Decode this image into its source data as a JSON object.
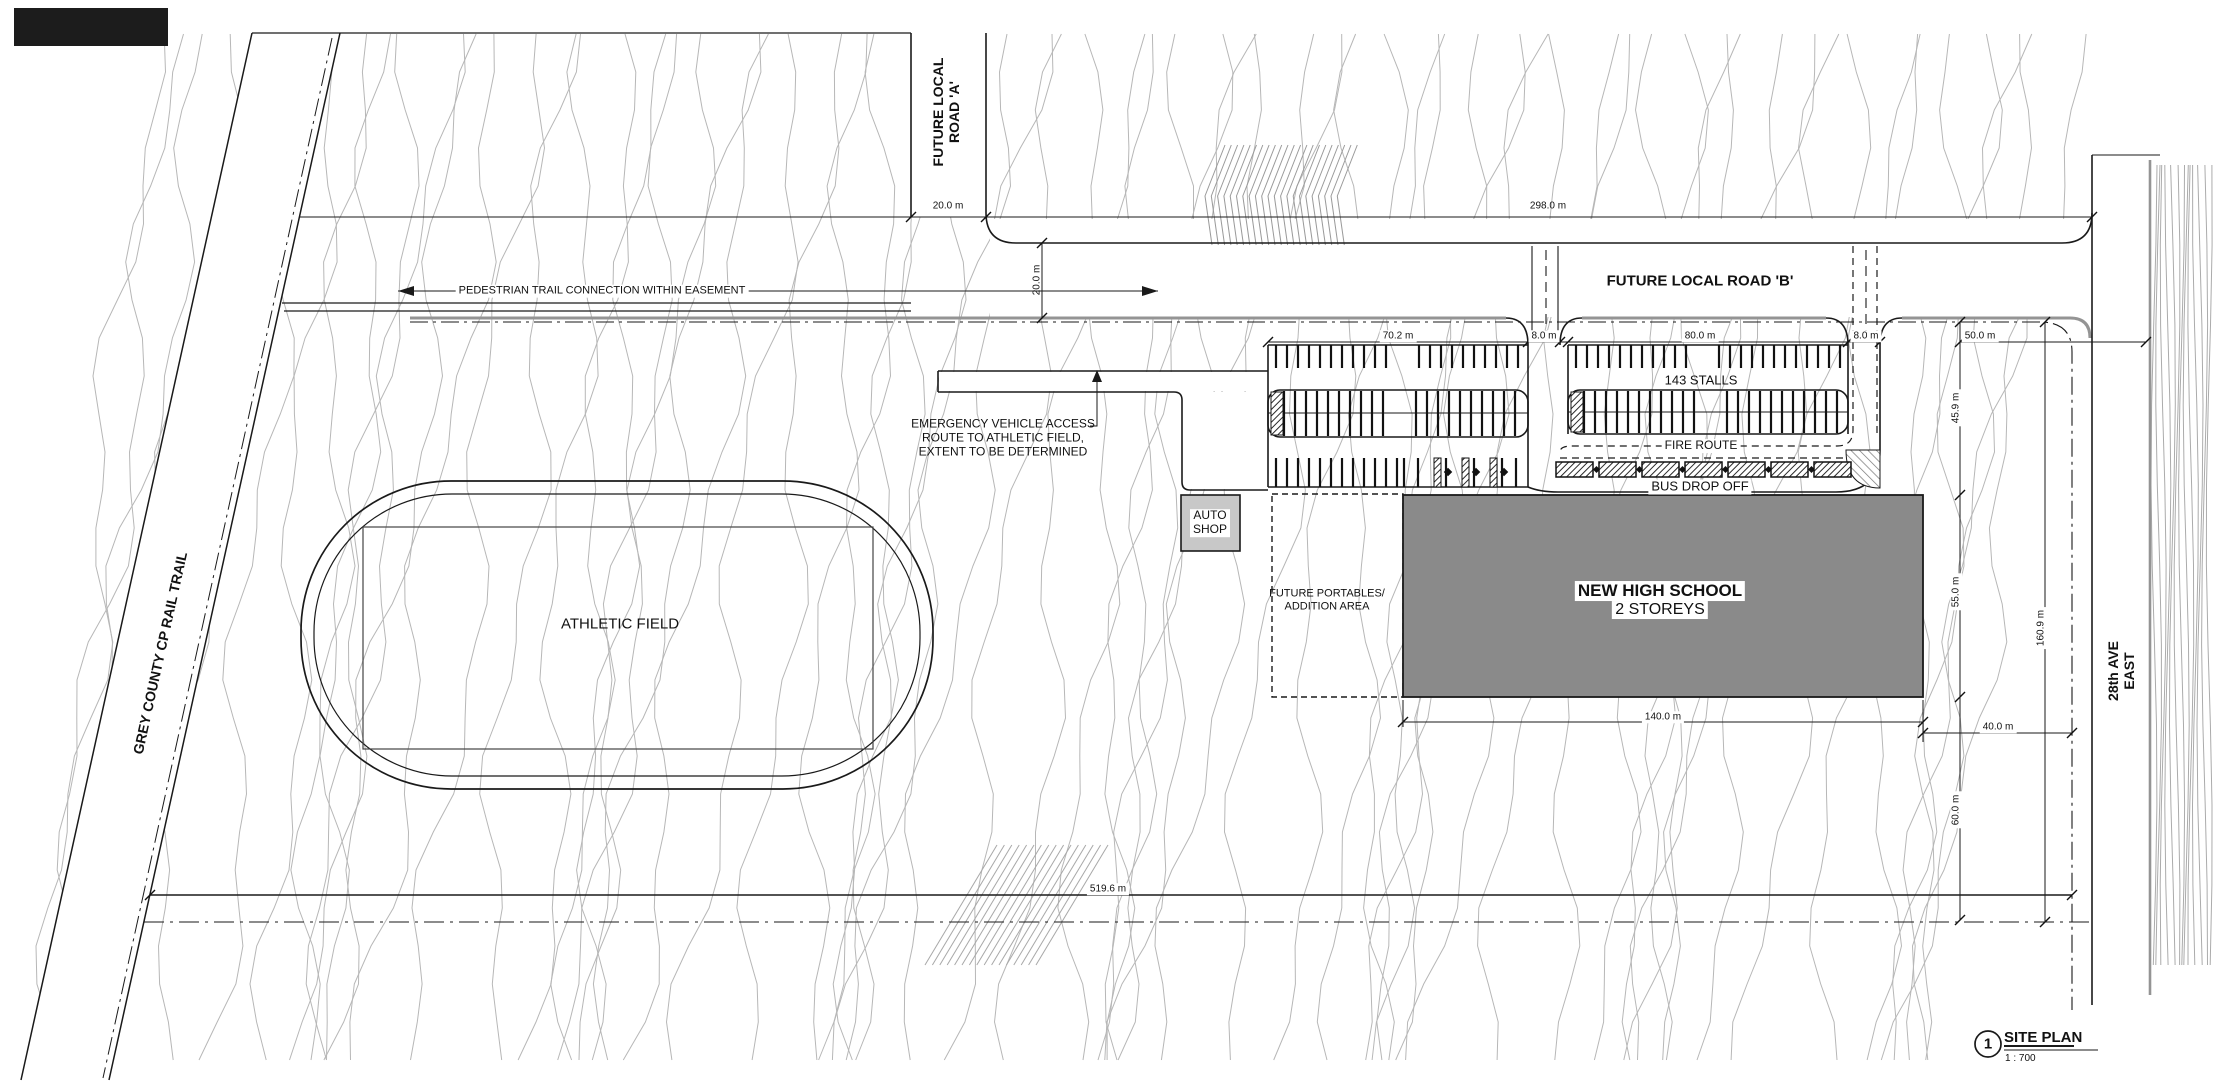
{
  "colors": {
    "line": "#1a1a1a",
    "contour": "#b7b7b7",
    "boundary_gray": "#949494",
    "school_fill": "#8a8a8a",
    "auto_shop_fill": "#c8c8c8",
    "hatch": "#555555"
  },
  "roads": {
    "road_a_label": "FUTURE LOCAL\nROAD 'A'",
    "road_b_label": "FUTURE LOCAL ROAD 'B'",
    "ave_east_label": "28th AVE EAST",
    "rail_trail_label": "GREY COUNTY CP RAIL TRAIL",
    "pedestrian_label": "PEDESTRIAN TRAIL CONNECTION WITHIN EASEMENT"
  },
  "site": {
    "athletic_field_label": "ATHLETIC FIELD",
    "emergency_note": "EMERGENCY VEHICLE ACCESS\nROUTE TO ATHLETIC FIELD,\nEXTENT TO BE DETERMINED",
    "auto_shop_label": "AUTO\nSHOP",
    "portables_label": "FUTURE PORTABLES/\nADDITION AREA",
    "school_name": "NEW HIGH SCHOOL",
    "school_storeys": "2 STOREYS",
    "stall_count_label": "143 STALLS",
    "fire_route_label": "FIRE ROUTE",
    "bus_drop_off_label": "BUS DROP OFF"
  },
  "dimensions": {
    "road_a_width": "20.0 m",
    "road_b_length": "298.0 m",
    "road_b_width": "20.0 m",
    "west_lot_width": "70.2 m",
    "west_entrance_width": "8.0 m",
    "east_lot_width": "80.0 m",
    "east_entrance_width": "8.0 m",
    "northeast_width": "50.0 m",
    "northeast_depth": "45.9 m",
    "school_depth": "55.0 m",
    "east_boundary_length": "160.9 m",
    "school_length": "140.0 m",
    "school_to_road": "40.0 m",
    "southeast_depth": "60.0 m",
    "south_boundary_length": "519.6 m"
  },
  "titleblock": {
    "detail_number": "1",
    "title": "SITE PLAN",
    "scale": "1 : 700"
  }
}
